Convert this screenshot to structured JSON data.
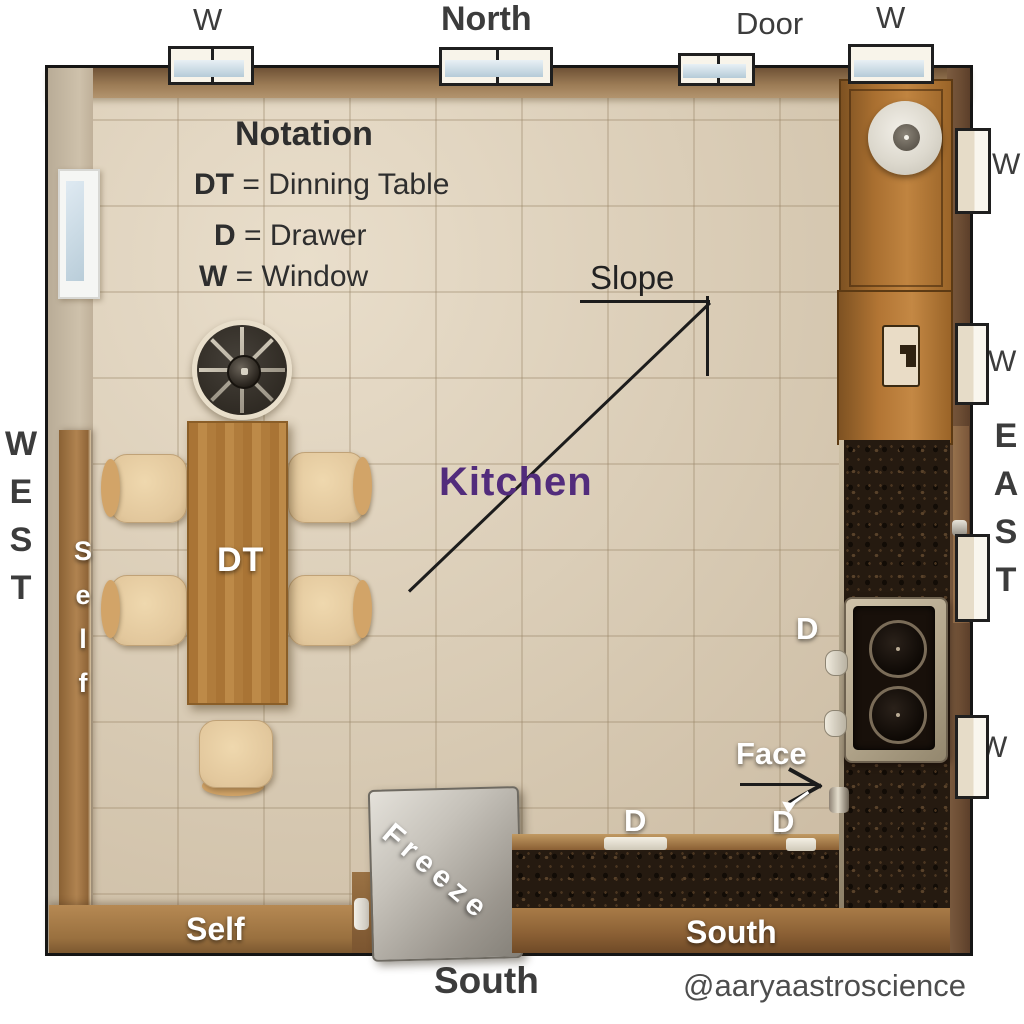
{
  "legend": {
    "title": "Notation",
    "items": [
      {
        "key": "DT",
        "rest": " = Dinning Table"
      },
      {
        "key": "D",
        "rest": " = Drawer"
      },
      {
        "key": "W",
        "rest": " = Window"
      }
    ]
  },
  "compass": {
    "north": "North",
    "south": "South",
    "west": [
      "W",
      "E",
      "S",
      "T"
    ],
    "east": [
      "E",
      "A",
      "S",
      "T"
    ]
  },
  "windows": {
    "top_left_w": "W",
    "door": "Door",
    "top_right_w": "W",
    "right_w1": "W",
    "right_w2": "W",
    "right_w3": "W"
  },
  "room": {
    "kitchen": "Kitchen",
    "slope": "Slope",
    "face": "Face"
  },
  "furniture": {
    "dining_table": "DT",
    "freezer": "Freeze",
    "shelf_left": "Self",
    "shelf_bottom": "Self",
    "counter_south": "South"
  },
  "drawers": {
    "d1": "D",
    "d2": "D",
    "d3": "D"
  },
  "watermark": "@aaryaastroscience",
  "colors": {
    "kitchen_label": "#522c7c",
    "wood": "#a97a42",
    "granite": "#251a10",
    "tile": "#d6c8b1",
    "stainless": "#b5a88e",
    "label_dark": "#3c3c3c"
  }
}
